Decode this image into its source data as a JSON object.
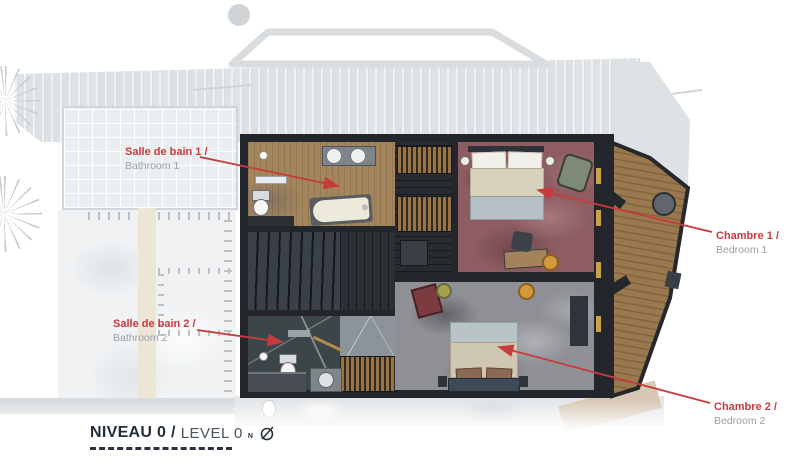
{
  "annotations": {
    "bathroom1": {
      "fr": "Salle de bain 1 /",
      "en": "Bathroom 1"
    },
    "bedroom1": {
      "fr": "Chambre 1 /",
      "en": "Bedroom 1"
    },
    "bathroom2": {
      "fr": "Salle de bain 2 /",
      "en": "Bathroom 2"
    },
    "bedroom2": {
      "fr": "Chambre 2 /",
      "en": "Bedroom 2"
    }
  },
  "legend": {
    "level_fr": "NIVEAU 0 /",
    "level_en": "LEVEL 0",
    "north_letter": "N"
  },
  "colors": {
    "annotation_red": "#c73b3d",
    "annotation_gray": "#98a0a7",
    "legend_dark": "#242e38",
    "carpet_bedroom1": "#8d5d61",
    "carpet_bedroom2": "#8e9096",
    "floor_bathroom1": "#a5855c",
    "floor_bathroom2": "#3c4547",
    "deck_wood": "#9a7950",
    "wall_dark": "#23272c"
  }
}
